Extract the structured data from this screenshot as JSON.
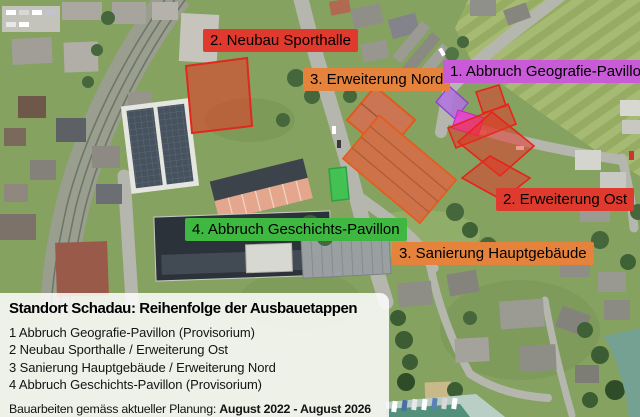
{
  "colors": {
    "red": "#e0392d",
    "orange": "#e5823c",
    "green": "#3eb841",
    "magenta": "#c95ad8",
    "overlay_red_fill": "rgba(232,48,35,0.5)",
    "overlay_magenta_fill": "#ea3fd3",
    "overlay_violet_fill": "#b273e2",
    "overlay_green_fill": "#3fc353",
    "overlay_building_stroke": "#e05a20"
  },
  "map_labels": [
    {
      "id": "neubau-sporthalle",
      "text": "2. Neubau Sporthalle",
      "color": "#e0392d"
    },
    {
      "id": "erweiterung-nord",
      "text": "3. Erweiterung Nord",
      "color": "#e5823c"
    },
    {
      "id": "abbruch-geografie-pavillon",
      "text": "1. Abbruch Geografie-Pavillon",
      "color": "#c95ad8"
    },
    {
      "id": "erweiterung-ost",
      "text": "2. Erweiterung Ost",
      "color": "#e0392d"
    },
    {
      "id": "abbruch-geschichts-pavillon",
      "text": "4. Abbruch Geschichts-Pavillon",
      "color": "#3eb841"
    },
    {
      "id": "sanierung-hauptgebaeude",
      "text": "3. Sanierung Hauptgebäude",
      "color": "#e5823c"
    }
  ],
  "legend": {
    "title": "Standort Schadau: Reihenfolge der Ausbauetappen",
    "items": [
      {
        "text": "1 Abbruch Geografie-Pavillon (Provisorium)"
      },
      {
        "text": "2 Neubau Sporthalle / Erweiterung Ost"
      },
      {
        "text": "3 Sanierung Hauptgebäude / Erweiterung Nord"
      },
      {
        "text": "4 Abbruch Geschichts-Pavillon (Provisorium)"
      }
    ],
    "footer_prefix": "Bauarbeiten gemäss aktueller Planung: ",
    "footer_dates": "August 2022 - August 2026"
  }
}
